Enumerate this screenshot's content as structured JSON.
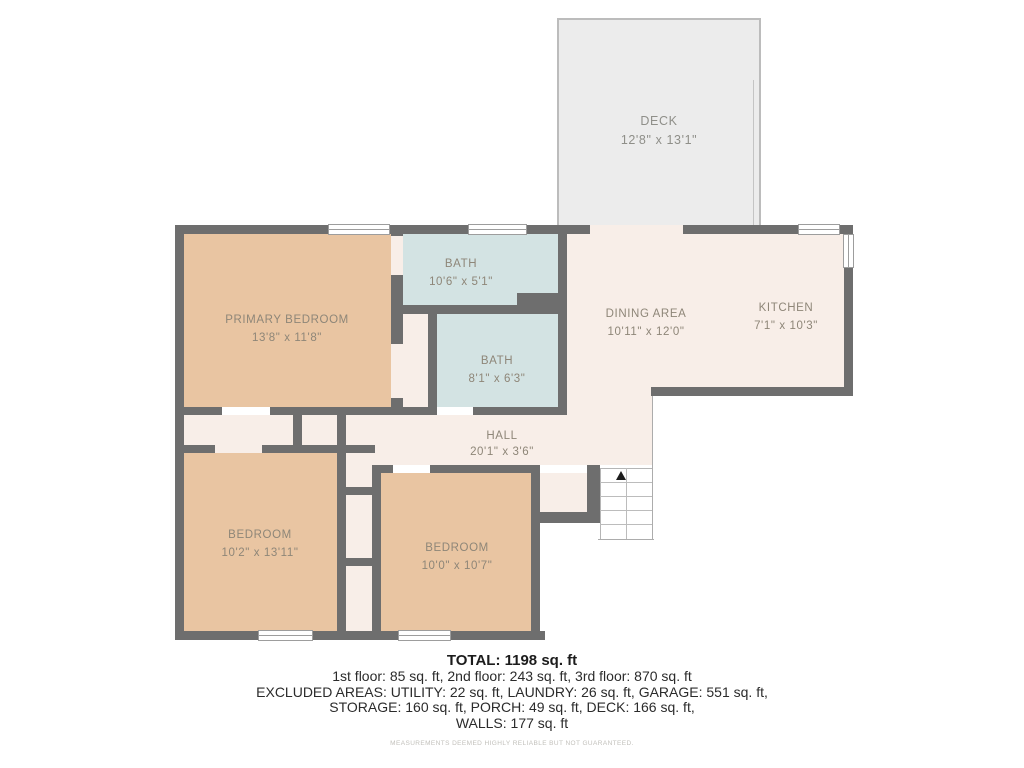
{
  "plan": {
    "deck": {
      "name": "DECK",
      "dims": "12'8\" x 13'1\""
    },
    "rooms": [
      {
        "id": "primary-bedroom",
        "name": "PRIMARY BEDROOM",
        "dims": "13'8\" x 11'8\""
      },
      {
        "id": "bath-upper",
        "name": "BATH",
        "dims": "10'6\" x 5'1\""
      },
      {
        "id": "bath-lower",
        "name": "BATH",
        "dims": "8'1\" x 6'3\""
      },
      {
        "id": "dining-area",
        "name": "DINING AREA",
        "dims": "10'11\" x 12'0\""
      },
      {
        "id": "kitchen",
        "name": "KITCHEN",
        "dims": "7'1\" x 10'3\""
      },
      {
        "id": "hall",
        "name": "HALL",
        "dims": "20'1\" x 3'6\""
      },
      {
        "id": "bedroom-left",
        "name": "BEDROOM",
        "dims": "10'2\" x 13'11\""
      },
      {
        "id": "bedroom-right",
        "name": "BEDROOM",
        "dims": "10'0\" x 10'7\""
      }
    ],
    "colors": {
      "wall": "#6e6e6e",
      "bedroom_fill": "#e9c5a2",
      "bath_fill": "#d3e3e3",
      "living_fill": "#f8eee8",
      "deck_fill": "#ececec",
      "label_text": "#8e8678"
    }
  },
  "summary": {
    "total": "TOTAL: 1198 sq. ft",
    "floors": "1st floor: 85 sq. ft, 2nd floor: 243 sq. ft, 3rd floor: 870 sq. ft",
    "excluded_line1": "EXCLUDED AREAS: UTILITY: 22 sq. ft, LAUNDRY: 26 sq. ft, GARAGE: 551 sq. ft,",
    "excluded_line2": "STORAGE: 160 sq. ft, PORCH: 49 sq. ft, DECK: 166 sq. ft,",
    "excluded_line3": "WALLS: 177 sq. ft",
    "disclaimer": "MEASUREMENTS DEEMED HIGHLY RELIABLE BUT NOT GUARANTEED."
  }
}
